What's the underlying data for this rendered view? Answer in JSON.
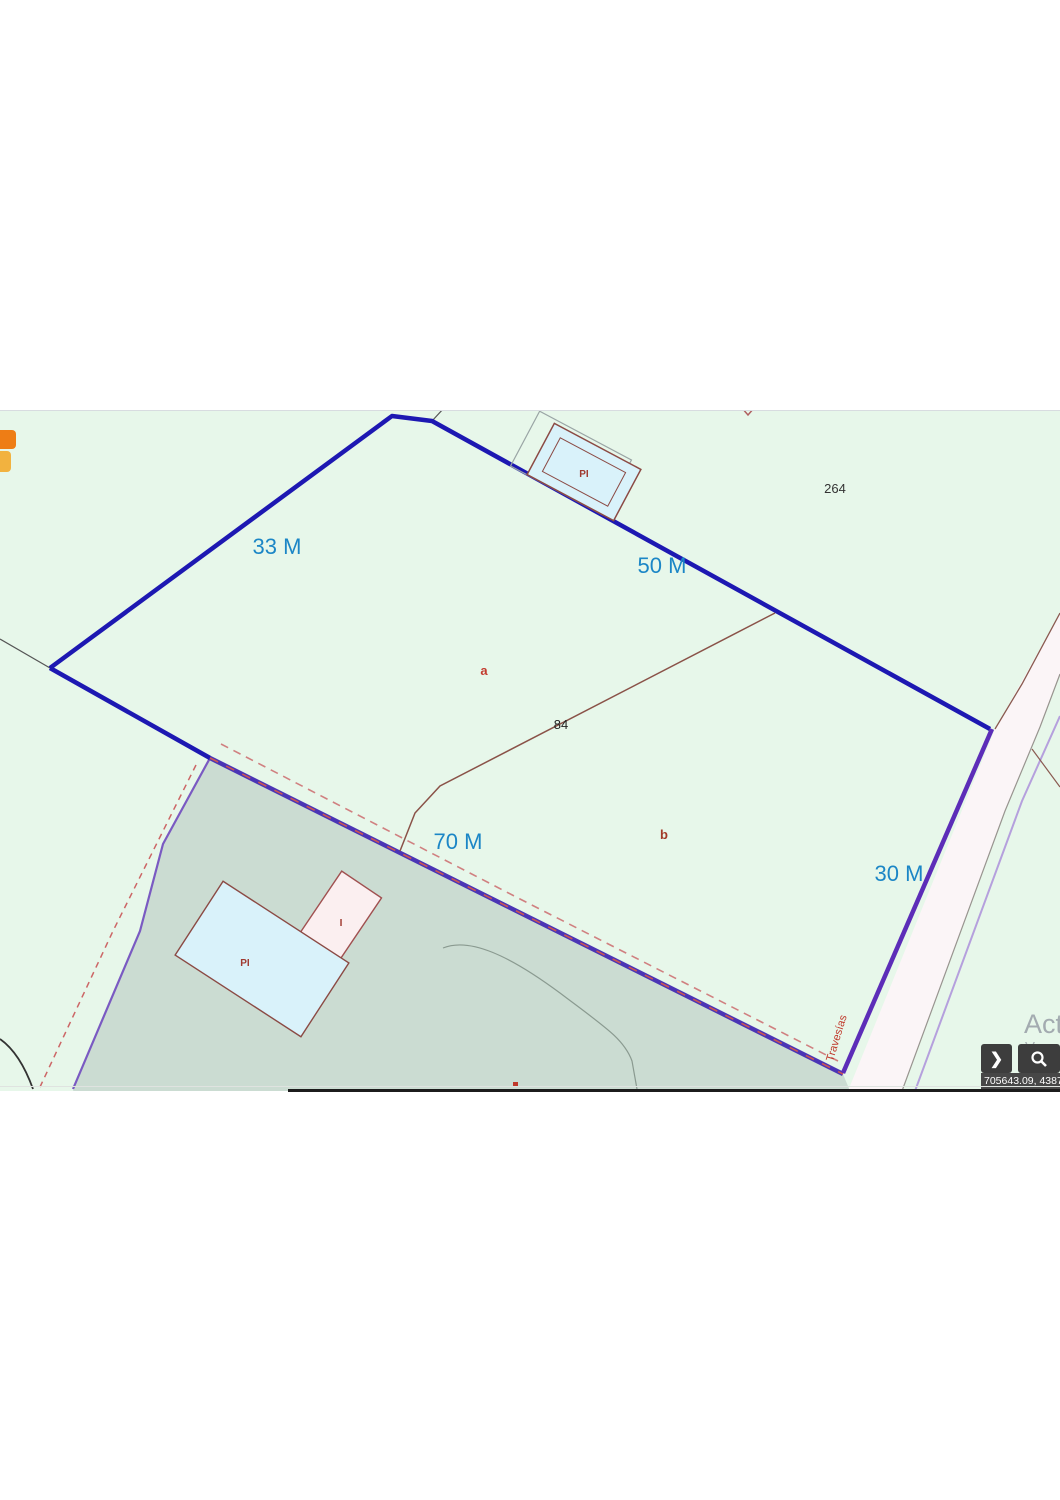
{
  "map": {
    "measurement_labels": {
      "side_33": "33 M",
      "side_50": "50 M",
      "side_70": "70 M",
      "side_30": "30 M"
    },
    "parcel_labels": {
      "neighbor_parcel": "264",
      "parcel_number": "84",
      "subparcel_a": "a",
      "subparcel_b": "b"
    },
    "building_labels": {
      "top_building": "PI",
      "bottom_main_building": "PI",
      "bottom_annex_building": "I"
    },
    "street_label": "Travesías"
  },
  "statusbar": {
    "coordinates": "705643.09, 43871",
    "nav_button_glyph": "❯"
  },
  "watermark": {
    "line1": "Acti",
    "line2": "Ve a"
  },
  "colors": {
    "map_background": "#e7f7ea",
    "greyed_zone": "#cbdcd2",
    "parcel_boundary_blue": "#1d18b2",
    "parcel_boundary_purple": "#5c2db8",
    "measurement_text_blue": "#1b86c6",
    "building_fill_blue": "#d9f2fa",
    "building_fill_pink": "#fbeff0",
    "building_outline_red": "#8b4a44",
    "road_fill": "#fbf5f7",
    "orange_button_dark": "#ee7d15",
    "orange_button_light": "#f2b23f",
    "control_button_bg": "#3d3d3d"
  }
}
